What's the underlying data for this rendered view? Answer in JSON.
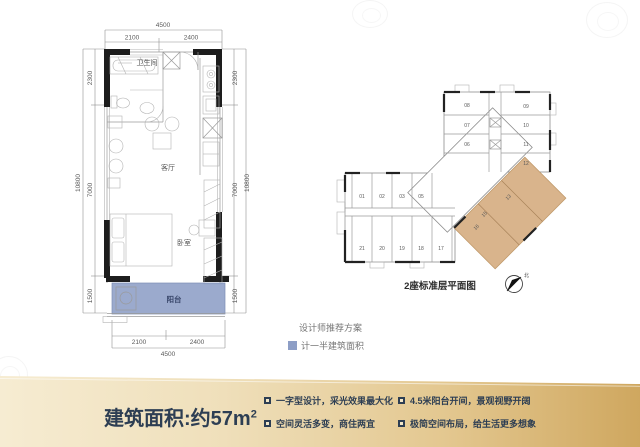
{
  "unit_plan": {
    "labels": {
      "bathroom": "卫生间",
      "living": "客厅",
      "bedroom": "卧室",
      "balcony": "阳台"
    },
    "dims": {
      "top_total": "4500",
      "top_left": "2100",
      "top_right": "2400",
      "bottom_left": "2100",
      "bottom_right": "2400",
      "bottom_total": "4500",
      "left_top": "2300",
      "left_mid": "7000",
      "left_total": "10800",
      "left_bottom": "1500",
      "right_top": "2300",
      "right_mid": "7000",
      "right_total": "10800",
      "right_bottom": "1500"
    },
    "balcony_color": "#8d9ec6"
  },
  "legend": {
    "recommend": "设计师推荐方案",
    "half_area": "计一半建筑面积",
    "half_area_color": "#8d9ec6"
  },
  "overview": {
    "caption": "2座标准层平面图",
    "compass_label": "北",
    "units_left_top": [
      "01",
      "02",
      "03",
      "05"
    ],
    "units_left_bottom": [
      "21",
      "20",
      "19",
      "18",
      "17"
    ],
    "units_right_left_col": [
      "08",
      "07",
      "06"
    ],
    "units_right_right_col": [
      "09",
      "10",
      "11",
      "12"
    ],
    "units_highlighted": [
      "13",
      "15",
      "16"
    ],
    "highlight_color": "#d9b48c"
  },
  "banner": {
    "area_text": "建筑面积:约57m",
    "area_sup": "2",
    "features": [
      "一字型设计，采光效果最大化",
      "空间灵活多变，商住两宜",
      "4.5米阳台开间，景观视野开阔",
      "极简空间布局，给生活更多想象"
    ]
  }
}
